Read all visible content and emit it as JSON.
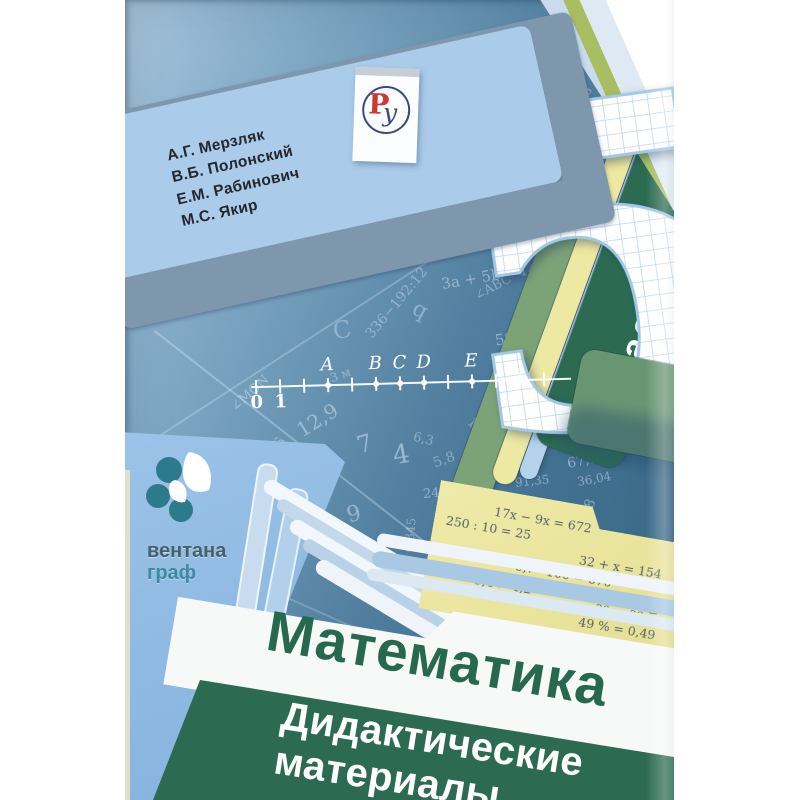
{
  "book": {
    "authors": [
      "А.Г. Мерзляк",
      "В.Б. Полонский",
      "Е.М. Рабинович",
      "М.С. Якир"
    ],
    "grade_number": "5",
    "grade_word": "класс",
    "title": "Математика",
    "subtitle_line1": "Дидактические",
    "subtitle_line2": "материалы",
    "publisher": {
      "name_line1": "вентана",
      "name_line2": "граф"
    },
    "imprint_logo": {
      "letter_r": "Р",
      "letter_u": "у"
    },
    "number_line": {
      "tick_count": 13,
      "labels_below": [
        {
          "label": "0",
          "tick": 0
        },
        {
          "label": "1",
          "tick": 1
        }
      ],
      "points": [
        {
          "label": "A",
          "tick": 3
        },
        {
          "label": "B",
          "tick": 5
        },
        {
          "label": "C",
          "tick": 6
        },
        {
          "label": "D",
          "tick": 7
        },
        {
          "label": "E",
          "tick": 9
        }
      ]
    },
    "note_equations": [
      "17x − 9x = 672",
      "250 : 10 = 25",
      "32 + x = 154",
      "6,7 · 100 = 670",
      "5,4 > 4,2",
      "12/36 − 5/36 =",
      "49 % = 0,49"
    ],
    "fraction": {
      "n1": "12",
      "d1": "36",
      "minus": "−",
      "n2": "5",
      "d2": "36",
      "eq": "="
    },
    "background_numbers": [
      [
        "67,86",
        413,
        40,
        75,
        20,
        0.5
      ],
      [
        "3,7",
        316,
        60,
        -12,
        16,
        0.45
      ],
      [
        "8,8",
        352,
        34,
        -25,
        13,
        0.4
      ],
      [
        "35",
        385,
        58,
        -35,
        13,
        0.4
      ],
      [
        "D",
        252,
        52,
        18,
        20,
        0.35
      ],
      [
        "62,9",
        250,
        178,
        -18,
        15,
        0.4
      ],
      [
        "231",
        395,
        150,
        -12,
        18,
        0.5
      ],
      [
        "456",
        350,
        172,
        -58,
        16,
        0.45
      ],
      [
        "179,3",
        436,
        150,
        -10,
        13,
        0.5
      ],
      [
        "529",
        420,
        190,
        68,
        12,
        0.4
      ],
      [
        "189,3",
        235,
        232,
        -8,
        17,
        0.5
      ],
      [
        "145",
        394,
        262,
        -8,
        14,
        0.55
      ],
      [
        "80",
        430,
        270,
        -48,
        14,
        0.5
      ],
      [
        "5",
        437,
        238,
        -22,
        24,
        0.5
      ],
      [
        "q",
        288,
        298,
        28,
        22,
        0.4
      ],
      [
        "C",
        208,
        316,
        -12,
        24,
        0.35
      ],
      [
        "∠ABC",
        348,
        280,
        -28,
        13,
        0.4
      ],
      [
        "3a + 5b",
        316,
        270,
        -10,
        15,
        0.45
      ],
      [
        "78",
        418,
        308,
        -72,
        19,
        0.5
      ],
      [
        "336−192:12",
        228,
        295,
        -50,
        14,
        0.4
      ],
      [
        "∠MON",
        102,
        386,
        -42,
        13,
        0.45
      ],
      [
        "12,9",
        170,
        408,
        -32,
        20,
        0.45
      ],
      [
        "396",
        136,
        442,
        -62,
        15,
        0.4
      ],
      [
        "0,345",
        268,
        528,
        -85,
        12,
        0.4
      ],
      [
        "240",
        298,
        486,
        -5,
        13,
        0.45
      ],
      [
        "2,675",
        220,
        546,
        -12,
        13,
        0.4
      ],
      [
        "∠MON",
        155,
        500,
        -15,
        13,
        0.4
      ],
      [
        "12",
        342,
        418,
        42,
        14,
        0.4
      ],
      [
        "345",
        402,
        372,
        -18,
        13,
        0.45
      ],
      [
        "5 м²",
        436,
        320,
        -15,
        13,
        0.5
      ],
      [
        "180°",
        455,
        278,
        -42,
        12,
        0.45
      ],
      [
        "12 м",
        458,
        342,
        -38,
        12,
        0.45
      ],
      [
        "30°",
        500,
        352,
        -45,
        12,
        0.45
      ],
      [
        "150",
        392,
        440,
        -8,
        15,
        0.5
      ],
      [
        "5,8",
        308,
        452,
        -20,
        14,
        0.4
      ],
      [
        "6,3",
        288,
        432,
        14,
        13,
        0.4
      ],
      [
        "4",
        268,
        440,
        -10,
        26,
        0.5
      ],
      [
        "7",
        232,
        430,
        -16,
        24,
        0.45
      ],
      [
        "9",
        222,
        502,
        -14,
        22,
        0.45
      ],
      [
        "67,86",
        442,
        452,
        -12,
        14,
        0.5
      ],
      [
        "91,35",
        390,
        474,
        -6,
        12,
        0.45
      ],
      [
        "36,04",
        452,
        472,
        -10,
        12,
        0.45
      ],
      [
        "12,48",
        436,
        96,
        -58,
        13,
        0.45
      ],
      [
        "87,86",
        452,
        120,
        -62,
        13,
        0.45
      ],
      [
        "178,2",
        414,
        352,
        -12,
        13,
        0.5
      ],
      [
        "59",
        370,
        330,
        -10,
        15,
        0.5
      ],
      [
        "78",
        455,
        500,
        -70,
        14,
        0.45
      ],
      [
        "3 м",
        205,
        368,
        -20,
        12,
        0.4
      ]
    ],
    "colors": {
      "cover_teal_dark": "#3d6c8a",
      "cover_teal_light": "#a9c6dd",
      "tab_light_blue": "#aacbe9",
      "tab_green": "#b2cb8a",
      "klass_dark_green": "#2c6b52",
      "band_yellow": "#eee9a2",
      "band_light_blue": "#b5d2ec",
      "band_green": "#7ca377",
      "note_yellow": "#ebe6a0",
      "title_green": "#27694f",
      "panel_green": "#2c6b52",
      "ventana_blue": "#8db9e2",
      "logo_teal": "#2d7a8c",
      "ru_red": "#cc3933",
      "ru_blue": "#3a4a7e"
    }
  }
}
